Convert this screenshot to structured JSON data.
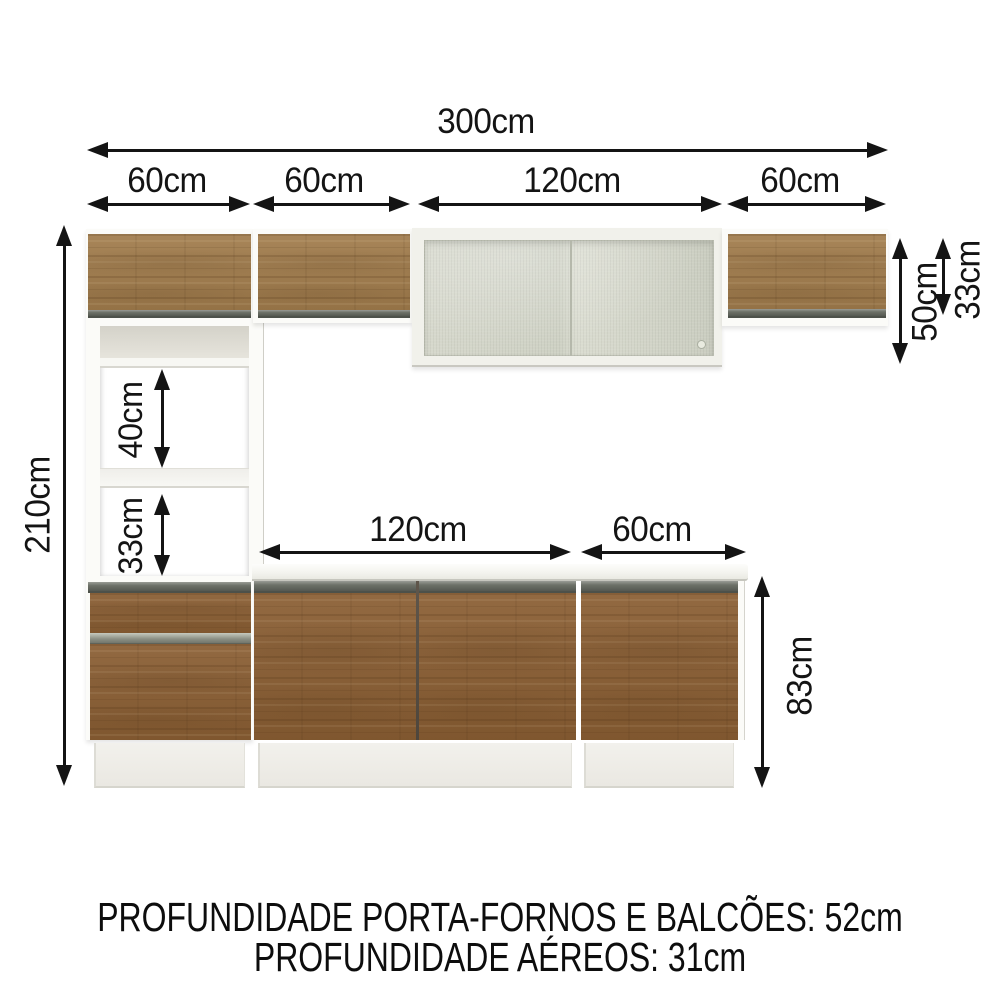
{
  "diagram": {
    "total_width_label": "300cm",
    "segments": [
      {
        "label": "60cm"
      },
      {
        "label": "60cm"
      },
      {
        "label": "120cm"
      },
      {
        "label": "60cm"
      }
    ],
    "total_height_label": "210cm",
    "glass_cabinet_height_label": "50cm",
    "wall_cabinet_height_label": "33cm",
    "oven_niche_height_label": "40cm",
    "lower_niche_height_label": "33cm",
    "counter_left_width_label": "120cm",
    "counter_right_width_label": "60cm",
    "base_cabinet_height_label": "83cm",
    "footer": {
      "line1": "PROFUNDIDADE PORTA-FORNOS E BALCÕES: 52cm",
      "line2": "PROFUNDIDADE AÉREOS: 31cm"
    },
    "colors": {
      "arrow": "#141414",
      "wood_aerial": "#a17c4c",
      "wood_base": "#8a5e33",
      "rail_gray": "#6d7168",
      "carcass_white": "#f9f9f5",
      "glass_green": "#d2d5c8"
    }
  }
}
